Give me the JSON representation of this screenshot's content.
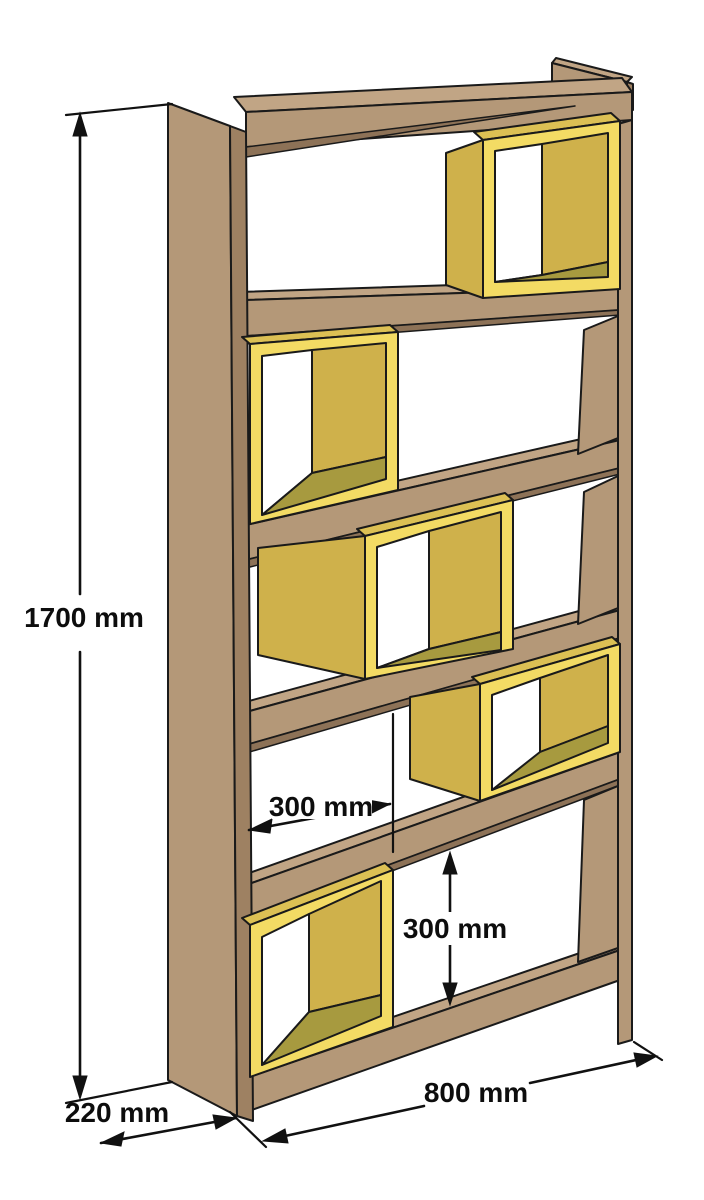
{
  "figure": {
    "type": "isometric-furniture-dimension-diagram",
    "object": "staggered-cube bookshelf",
    "background_color": "#ffffff",
    "outline_color": "#1a1a1a"
  },
  "dimensions": {
    "height": {
      "label": "1700 mm",
      "value": 1700,
      "unit": "mm",
      "measures": "overall height"
    },
    "depth": {
      "label": "220 mm",
      "value": 220,
      "unit": "mm",
      "measures": "side panel depth"
    },
    "width": {
      "label": "800 mm",
      "value": 800,
      "unit": "mm",
      "measures": "overall width"
    },
    "box_offset": {
      "label": "300 mm",
      "value": 300,
      "unit": "mm",
      "measures": "horizontal box module"
    },
    "cell_height": {
      "label": "300 mm",
      "value": 300,
      "unit": "mm",
      "measures": "shelf opening height"
    }
  },
  "structure": {
    "shelf_boards": 6,
    "open_cells": 5,
    "cube_boxes": 5,
    "box_positions_top_to_bottom": [
      "right",
      "left",
      "middle",
      "right",
      "left"
    ]
  },
  "colors": {
    "wood_face": "#B49878",
    "wood_top": "#C1A585",
    "wood_edge_dark": "#9E8162",
    "wood_shadow": "#8D7257",
    "box_frame_yellow": "#F3DB64",
    "box_side_yellow": "#CFB14B",
    "box_top_yellow": "#DCC054",
    "box_floor_olive": "#A79A3F"
  }
}
